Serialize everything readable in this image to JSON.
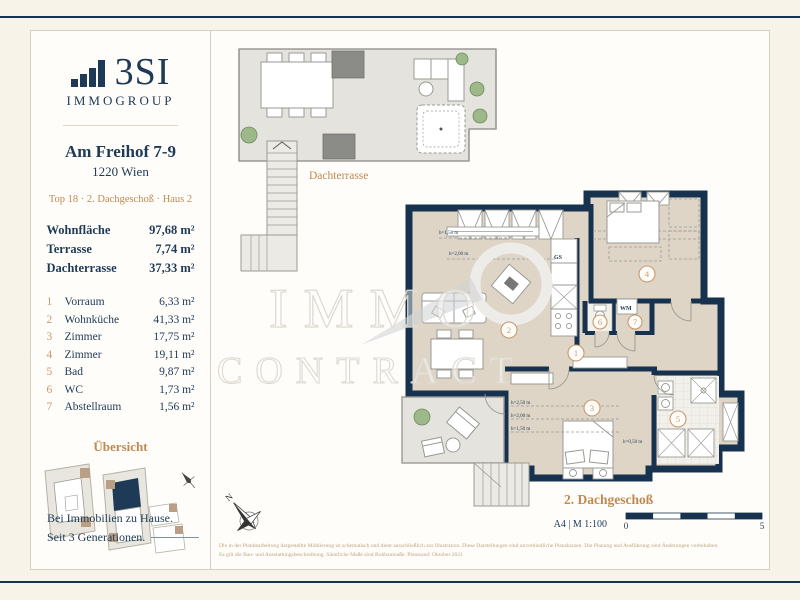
{
  "brand": {
    "name": "3SI",
    "sub": "IMMOGROUP"
  },
  "listing": {
    "street": "Am Freihof 7-9",
    "city": "1220 Wien",
    "unit": "Top 18 · 2. Dachgeschoß · Haus 2"
  },
  "summary": [
    {
      "label": "Wohnfläche",
      "value": "97,68 m²"
    },
    {
      "label": "Terrasse",
      "value": "7,74 m²"
    },
    {
      "label": "Dachterrasse",
      "value": "37,33 m²"
    }
  ],
  "rooms": [
    {
      "no": "1",
      "name": "Vorraum",
      "area": "6,33 m²"
    },
    {
      "no": "2",
      "name": "Wohnküche",
      "area": "41,33 m²"
    },
    {
      "no": "3",
      "name": "Zimmer",
      "area": "17,75 m²"
    },
    {
      "no": "4",
      "name": "Zimmer",
      "area": "19,11 m²"
    },
    {
      "no": "5",
      "name": "Bad",
      "area": "9,87 m²"
    },
    {
      "no": "6",
      "name": "WC",
      "area": "1,73 m²"
    },
    {
      "no": "7",
      "name": "Abstellraum",
      "area": "1,56 m²"
    }
  ],
  "overview": {
    "title": "Übersicht"
  },
  "tagline": {
    "line1": "Bei Immobilien zu Hause.",
    "line2": "Seit 3 Generationen."
  },
  "plan": {
    "roof_terrace_label": "Dachterrasse",
    "floor_label": "2. Dachgeschoß",
    "gs": "GS",
    "wm": "WM",
    "north": "N",
    "h_living_1": "h=1,50 m",
    "h_living_2": "h=2,00 m",
    "h_room3_1": "h=2,50 m",
    "h_room3_2": "h=2,00 m",
    "h_room3_3": "h=1,50 m",
    "h_room3_4": "h=0,50 m"
  },
  "watermark": {
    "line1": "IMMO",
    "line2": "CONTRACT"
  },
  "footer": {
    "format": "A4 | M 1:100",
    "scale_start": "0",
    "scale_end": "5",
    "disclaimer_line1": "Die in der Planbearbeitung dargestellte Möblierung ist schematisch und dient ausschließlich zur Illustration. Diese Darstellungen sind unverbindliche Planskizzen. Die Planung und Ausführung sind Änderungen vorbehalten.",
    "disclaimer_line2": "Es gilt die Bau- und Ausstattungsbeschreibung. Sämtliche Maße sind Rohbaumaße. Planstand: Oktober 2021"
  },
  "colors": {
    "navy": "#1e3a56",
    "wall": "#16324e",
    "tan": "#bf8a50",
    "tan_light": "#c9996b",
    "floor_beige": "#ded5c7",
    "terrace_gray": "#e4e3de",
    "cream": "#f8f3e9"
  }
}
